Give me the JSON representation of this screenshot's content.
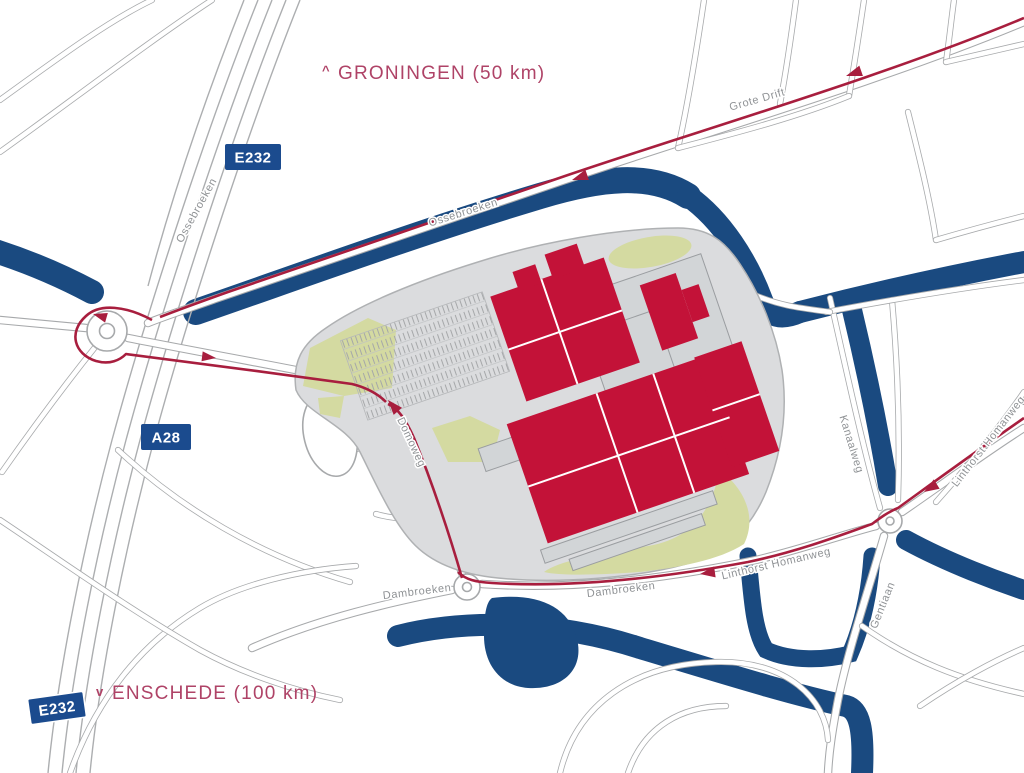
{
  "destinations": {
    "north": {
      "chevron": "^",
      "label": "GRONINGEN (50 km)"
    },
    "south": {
      "chevron": "v",
      "label": "ENSCHEDE (100 km)"
    }
  },
  "road_shields": {
    "e232_top": "E232",
    "a28": "A28",
    "e232_bottom": "E232"
  },
  "street_labels": {
    "ossebroeken_highway": "Ossebroeken",
    "ossebroeken_route": "Ossebroeken",
    "grote_drift": "Grote Drift",
    "domoweg": "Domoweg",
    "dambroeken_west": "Dambroeken",
    "dambroeken_east": "Dambroeken",
    "linthorst_homanweg_bottom": "Linthorst Homanweg",
    "linthorst_homanweg_east": "Linthorst Homanweg",
    "kanaalweg": "Kanaalweg",
    "gentiaan": "Gentiaan"
  },
  "colors": {
    "water": "#1A4A80",
    "shield_blue": "#1B4B8E",
    "building_red": "#C31238",
    "route_red": "#A81E3E",
    "destination_text": "#AF4367",
    "street_text": "#8F9295",
    "road_casing": "#A7A9AB",
    "terrain_gray": "#DBDCDE",
    "building_gray": "#D2D5D7",
    "green_area": "#D4DAA1"
  }
}
